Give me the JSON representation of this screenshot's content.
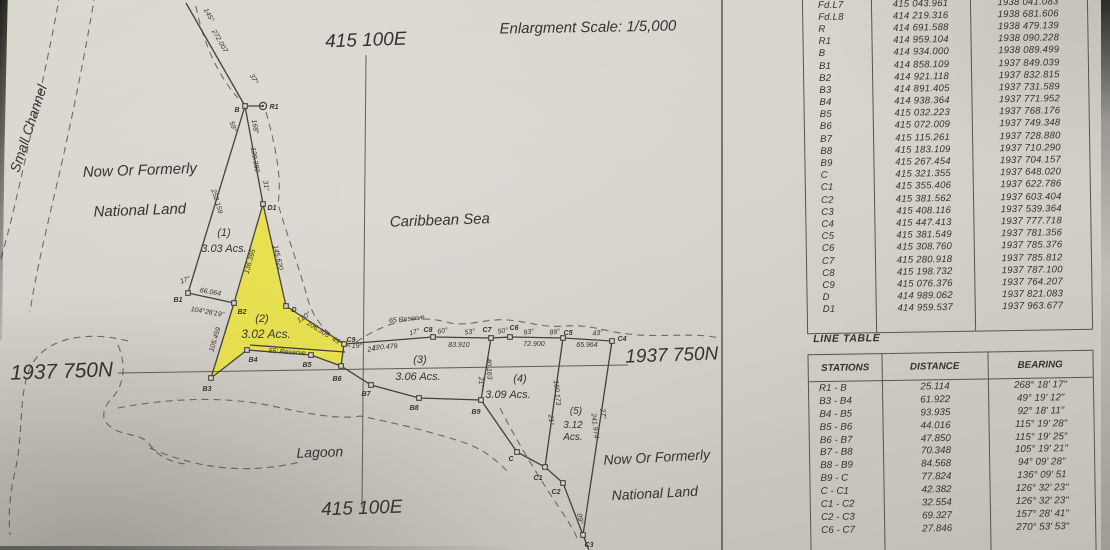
{
  "map": {
    "colors": {
      "line": "#45423c",
      "highlight": "#e9e23b",
      "marker_fill": "#d9d6ce"
    },
    "scale_note": "Enlargment Scale: 1/5,000",
    "parcels": [
      {
        "id": "(1)",
        "area": "3.03 Acs.",
        "highlighted": false
      },
      {
        "id": "(2)",
        "area": "3.02 Acs.",
        "highlighted": true
      },
      {
        "id": "(3)",
        "area": "3.06 Acs.",
        "highlighted": false
      },
      {
        "id": "(4)",
        "area": "3.09 Acs.",
        "highlighted": false
      },
      {
        "id": "(5)",
        "area": "3.12 Acs.",
        "highlighted": false
      }
    ],
    "grid": {
      "lines": [
        [
          366,
          55,
          362,
          508
        ],
        [
          118,
          373,
          628,
          365
        ]
      ]
    },
    "highlight_parcel": {
      "points": "263,206 234,303 211,378 247,350 311,355 341,366 344,344 286,306"
    },
    "solid_lines": [
      "186,3 245,106",
      "245,106 263,106",
      "245,106 188,293",
      "245,106 263,204",
      "188,293 234,303",
      "263,204 234,303",
      "234,303 211,378",
      "211,378 247,350",
      "247,350 311,355 341,366 371,385 419,398 481,400 517,452 545,467 563,483 583,535",
      "263,204 286,306",
      "286,306 344,344",
      "344,344 433,337 491,338 510,337 563,338 612,341",
      "491,338 481,400",
      "563,338 545,467",
      "612,341 583,535",
      "344,344 341,366",
      "250,345 345,352",
      "722,0 722,550",
      "583,535 589,550"
    ],
    "dashed_paths": [
      "M 60,-6 C 48,60 32,130 16,200 C 10,226 4,248 0,262",
      "M 95,-6 C 85,55 70,130 52,205 C 44,240 35,278 30,312",
      "M 128,341 C 86,330 44,338 30,368 C 18,395 24,436 14,476 C 10,496 8,516 10,535",
      "M 118,345 C 128,368 122,388 112,398 C 102,409 100,420 112,428 C 126,437 142,433 150,445 C 158,456 170,462 185,464",
      "M 150,448 C 200,470 250,474 300,462",
      "M 196,6 C 202,40 218,76 238,98",
      "M 266,112 C 276,148 282,178 278,204 C 288,238 300,270 308,300 C 316,326 334,340 354,348",
      "M 356,342 C 386,322 416,314 446,322 C 466,328 486,318 508,320 C 530,322 544,328 566,326 C 590,324 606,332 628,334 C 660,338 694,332 719,338",
      "M 118,408 C 170,398 225,396 272,406 C 305,413 338,420 360,416 C 400,424 440,434 468,444 C 488,452 498,462 508,472",
      "M 500,408 C 514,436 532,466 550,494 C 562,512 572,526 578,540"
    ],
    "stations": [
      {
        "id": "B",
        "x": 245,
        "y": 106,
        "shape": "square"
      },
      {
        "id": "R1",
        "x": 263,
        "y": 106,
        "shape": "circle"
      },
      {
        "id": "D1",
        "x": 263,
        "y": 204,
        "shape": "square"
      },
      {
        "id": "B1",
        "x": 188,
        "y": 293,
        "shape": "square"
      },
      {
        "id": "B2",
        "x": 234,
        "y": 303,
        "shape": "square"
      },
      {
        "id": "B3",
        "x": 211,
        "y": 378,
        "shape": "square"
      },
      {
        "id": "B4",
        "x": 247,
        "y": 350,
        "shape": "square"
      },
      {
        "id": "B5",
        "x": 311,
        "y": 355,
        "shape": "square"
      },
      {
        "id": "B6",
        "x": 341,
        "y": 366,
        "shape": "square"
      },
      {
        "id": "B7",
        "x": 371,
        "y": 385,
        "shape": "square"
      },
      {
        "id": "B8",
        "x": 419,
        "y": 398,
        "shape": "square"
      },
      {
        "id": "B9",
        "x": 481,
        "y": 400,
        "shape": "square"
      },
      {
        "id": "C",
        "x": 517,
        "y": 452,
        "shape": "square"
      },
      {
        "id": "C1",
        "x": 545,
        "y": 467,
        "shape": "square"
      },
      {
        "id": "C2",
        "x": 563,
        "y": 483,
        "shape": "square"
      },
      {
        "id": "C3",
        "x": 583,
        "y": 535,
        "shape": "square"
      },
      {
        "id": "C4",
        "x": 612,
        "y": 341,
        "shape": "square"
      },
      {
        "id": "C5",
        "x": 563,
        "y": 338,
        "shape": "square"
      },
      {
        "id": "C6",
        "x": 510,
        "y": 337,
        "shape": "square"
      },
      {
        "id": "C7",
        "x": 491,
        "y": 338,
        "shape": "square"
      },
      {
        "id": "C8",
        "x": 433,
        "y": 337,
        "shape": "square"
      },
      {
        "id": "C9",
        "x": 344,
        "y": 344,
        "shape": "square"
      },
      {
        "id": "D",
        "x": 286,
        "y": 306,
        "shape": "square"
      }
    ],
    "labels": [
      {
        "t": "Enlargment Scale: 1/5,000",
        "x": 588,
        "y": 32,
        "s": 15,
        "r": -1,
        "n": "scale-note"
      },
      {
        "t": "415 100E",
        "x": 366,
        "y": 46,
        "s": 19,
        "r": -2,
        "n": "grid-label-easting-top"
      },
      {
        "t": "415 100E",
        "x": 362,
        "y": 514,
        "s": 19,
        "r": -2,
        "n": "grid-label-easting-bottom"
      },
      {
        "t": "1937 750N",
        "x": 62,
        "y": 378,
        "s": 21,
        "r": -2,
        "n": "grid-label-northing-left"
      },
      {
        "t": "1937 750N",
        "x": 672,
        "y": 361,
        "s": 19,
        "r": -2,
        "n": "grid-label-northing-right"
      },
      {
        "t": "Small Channel",
        "x": 33,
        "y": 130,
        "s": 14,
        "r": -72,
        "n": "area-label-small-channel"
      },
      {
        "t": "Now Or Formerly",
        "x": 140,
        "y": 175,
        "s": 15,
        "r": -2,
        "n": "area-label-now-or-formerly-nw"
      },
      {
        "t": "National Land",
        "x": 140,
        "y": 215,
        "s": 15,
        "r": -2,
        "n": "area-label-national-land-nw"
      },
      {
        "t": "Caribbean Sea",
        "x": 440,
        "y": 225,
        "s": 15,
        "r": -2,
        "n": "area-label-caribbean-sea"
      },
      {
        "t": "Lagoon",
        "x": 320,
        "y": 457,
        "s": 14,
        "r": -2,
        "n": "area-label-lagoon"
      },
      {
        "t": "Now Or Formerly",
        "x": 657,
        "y": 462,
        "s": 14,
        "r": -3,
        "n": "area-label-now-or-formerly-se"
      },
      {
        "t": "National Land",
        "x": 655,
        "y": 498,
        "s": 14,
        "r": -3,
        "n": "area-label-national-land-se"
      },
      {
        "t": "(1)",
        "x": 224,
        "y": 236,
        "s": 11,
        "n": "parcel-1-id"
      },
      {
        "t": "3.03 Acs.",
        "x": 224,
        "y": 252,
        "s": 11,
        "n": "parcel-1-area"
      },
      {
        "t": "(2)",
        "x": 262,
        "y": 322,
        "s": 11,
        "n": "parcel-2-id"
      },
      {
        "t": "3.02 Acs.",
        "x": 266,
        "y": 338,
        "s": 12,
        "n": "parcel-2-area"
      },
      {
        "t": "(3)",
        "x": 420,
        "y": 363,
        "s": 11,
        "n": "parcel-3-id"
      },
      {
        "t": "3.06 Acs.",
        "x": 418,
        "y": 380,
        "s": 11,
        "n": "parcel-3-area"
      },
      {
        "t": "(4)",
        "x": 520,
        "y": 382,
        "s": 11,
        "n": "parcel-4-id"
      },
      {
        "t": "3.09 Acs.",
        "x": 508,
        "y": 398,
        "s": 11,
        "n": "parcel-4-area"
      },
      {
        "t": "(5)",
        "x": 576,
        "y": 414,
        "s": 10,
        "n": "parcel-5-id"
      },
      {
        "t": "3.12",
        "x": 573,
        "y": 428,
        "s": 10,
        "n": "parcel-5-area"
      },
      {
        "t": "Acs.",
        "x": 573,
        "y": 440,
        "s": 10,
        "n": "parcel-5-area-unit"
      },
      {
        "t": "B",
        "x": 237,
        "y": 112,
        "s": 7,
        "b": 1,
        "n": "station-label"
      },
      {
        "t": "R1",
        "x": 274,
        "y": 109,
        "s": 7,
        "b": 1,
        "n": "station-label"
      },
      {
        "t": "D1",
        "x": 272,
        "y": 210,
        "s": 7,
        "b": 1,
        "n": "station-label"
      },
      {
        "t": "B1",
        "x": 178,
        "y": 302,
        "s": 7,
        "b": 1,
        "n": "station-label"
      },
      {
        "t": "B2",
        "x": 242,
        "y": 314,
        "s": 7,
        "b": 1,
        "n": "station-label"
      },
      {
        "t": "B3",
        "x": 207,
        "y": 391,
        "s": 7,
        "b": 1,
        "n": "station-label"
      },
      {
        "t": "B4",
        "x": 253,
        "y": 362,
        "s": 7,
        "b": 1,
        "n": "station-label"
      },
      {
        "t": "B5",
        "x": 307,
        "y": 367,
        "s": 7,
        "b": 1,
        "n": "station-label"
      },
      {
        "t": "B6",
        "x": 337,
        "y": 381,
        "s": 7,
        "b": 1,
        "n": "station-label"
      },
      {
        "t": "B7",
        "x": 366,
        "y": 396,
        "s": 7,
        "b": 1,
        "n": "station-label"
      },
      {
        "t": "B8",
        "x": 414,
        "y": 410,
        "s": 7,
        "b": 1,
        "n": "station-label"
      },
      {
        "t": "B9",
        "x": 476,
        "y": 414,
        "s": 7,
        "b": 1,
        "n": "station-label"
      },
      {
        "t": "C",
        "x": 511,
        "y": 461,
        "s": 7,
        "b": 1,
        "n": "station-label"
      },
      {
        "t": "C1",
        "x": 538,
        "y": 480,
        "s": 7,
        "b": 1,
        "n": "station-label"
      },
      {
        "t": "C2",
        "x": 556,
        "y": 494,
        "s": 7,
        "b": 1,
        "n": "station-label"
      },
      {
        "t": "C3",
        "x": 589,
        "y": 547,
        "s": 7,
        "b": 1,
        "n": "station-label"
      },
      {
        "t": "C4",
        "x": 622,
        "y": 341,
        "s": 7,
        "b": 1,
        "n": "station-label"
      },
      {
        "t": "C5",
        "x": 568,
        "y": 335,
        "s": 7,
        "b": 1,
        "n": "station-label"
      },
      {
        "t": "C6",
        "x": 514,
        "y": 330,
        "s": 7,
        "b": 1,
        "n": "station-label"
      },
      {
        "t": "C7",
        "x": 487,
        "y": 332,
        "s": 7,
        "b": 1,
        "n": "station-label"
      },
      {
        "t": "C8",
        "x": 428,
        "y": 332,
        "s": 7,
        "b": 1,
        "n": "station-label"
      },
      {
        "t": "C9",
        "x": 351,
        "y": 342,
        "s": 7,
        "b": 1,
        "n": "station-label"
      },
      {
        "t": "D",
        "x": 294,
        "y": 312,
        "s": 7,
        "b": 1,
        "n": "station-label"
      },
      {
        "t": "145°",
        "x": 207,
        "y": 16,
        "s": 7,
        "r": 60,
        "n": "measure-label"
      },
      {
        "t": "272.007",
        "x": 218,
        "y": 42,
        "s": 7,
        "r": 60,
        "n": "measure-label"
      },
      {
        "t": "37°",
        "x": 252,
        "y": 80,
        "s": 7,
        "r": 60,
        "n": "measure-label"
      },
      {
        "t": "59°",
        "x": 231,
        "y": 127,
        "s": 7,
        "r": 72,
        "n": "measure-label"
      },
      {
        "t": "168°",
        "x": 253,
        "y": 127,
        "s": 7,
        "r": 80,
        "n": "measure-label"
      },
      {
        "t": "129.380",
        "x": 253,
        "y": 160,
        "s": 7,
        "r": 80,
        "n": "measure-label"
      },
      {
        "t": "31°",
        "x": 264,
        "y": 186,
        "s": 7,
        "r": 80,
        "n": "measure-label"
      },
      {
        "t": "252.159",
        "x": 215,
        "y": 202,
        "s": 7,
        "r": 73,
        "n": "measure-label"
      },
      {
        "t": "136.395",
        "x": 252,
        "y": 262,
        "s": 7,
        "r": -74,
        "n": "measure-label"
      },
      {
        "t": "145.620",
        "x": 276,
        "y": 258,
        "s": 7,
        "r": 77,
        "n": "measure-label"
      },
      {
        "t": "17°",
        "x": 186,
        "y": 282,
        "s": 7,
        "r": -20,
        "n": "measure-label"
      },
      {
        "t": "66.064",
        "x": 210,
        "y": 294,
        "s": 7,
        "r": 10,
        "n": "measure-label"
      },
      {
        "t": "104°26'19\"",
        "x": 207,
        "y": 314,
        "s": 7,
        "r": 10,
        "n": "measure-label"
      },
      {
        "t": "105.459",
        "x": 217,
        "y": 340,
        "s": 7,
        "r": -73,
        "n": "measure-label"
      },
      {
        "t": "120°",
        "x": 305,
        "y": 319,
        "s": 7,
        "r": -33,
        "n": "measure-label"
      },
      {
        "t": "106.305",
        "x": 317,
        "y": 331,
        "s": 7,
        "r": 33,
        "n": "measure-label"
      },
      {
        "t": "49°",
        "x": 336,
        "y": 343,
        "s": 7,
        "r": 33,
        "n": "measure-label"
      },
      {
        "t": "65' Reserve",
        "x": 287,
        "y": 354,
        "s": 7,
        "r": 4,
        "n": "measure-label"
      },
      {
        "t": "65 Reserve",
        "x": 407,
        "y": 321,
        "s": 7,
        "r": -6,
        "n": "measure-label"
      },
      {
        "t": "19°",
        "x": 357,
        "y": 348,
        "s": 7,
        "r": 0,
        "n": "measure-label"
      },
      {
        "t": "24°",
        "x": 373,
        "y": 351,
        "s": 7,
        "r": -8,
        "n": "measure-label"
      },
      {
        "t": "120.479",
        "x": 385,
        "y": 349,
        "s": 7,
        "r": -4,
        "n": "measure-label"
      },
      {
        "t": "17°",
        "x": 415,
        "y": 334,
        "s": 7,
        "r": -15,
        "n": "measure-label"
      },
      {
        "t": "60°",
        "x": 443,
        "y": 333,
        "s": 7,
        "r": -10,
        "n": "measure-label"
      },
      {
        "t": "83.910",
        "x": 459,
        "y": 347,
        "s": 7,
        "r": 0,
        "n": "measure-label"
      },
      {
        "t": "53°",
        "x": 470,
        "y": 334,
        "s": 7,
        "r": -8,
        "n": "measure-label"
      },
      {
        "t": "50°",
        "x": 503,
        "y": 333,
        "s": 7,
        "r": -8,
        "n": "measure-label"
      },
      {
        "t": "93°",
        "x": 529,
        "y": 334,
        "s": 7,
        "r": -8,
        "n": "measure-label"
      },
      {
        "t": "72.900",
        "x": 534,
        "y": 346,
        "s": 7,
        "r": 0,
        "n": "measure-label"
      },
      {
        "t": "89°",
        "x": 555,
        "y": 334,
        "s": 7,
        "r": -8,
        "n": "measure-label"
      },
      {
        "t": "65.964",
        "x": 587,
        "y": 347,
        "s": 7,
        "r": 0,
        "n": "measure-label"
      },
      {
        "t": "43°",
        "x": 598,
        "y": 335,
        "s": 7,
        "r": -8,
        "n": "measure-label"
      },
      {
        "t": "40.163",
        "x": 487,
        "y": 369,
        "s": 7,
        "r": 87,
        "n": "measure-label"
      },
      {
        "t": "21°",
        "x": 479,
        "y": 382,
        "s": 7,
        "r": 87,
        "n": "measure-label"
      },
      {
        "t": "160.173",
        "x": 555,
        "y": 393,
        "s": 7,
        "r": 84,
        "n": "measure-label"
      },
      {
        "t": "21°",
        "x": 549,
        "y": 420,
        "s": 7,
        "r": 84,
        "n": "measure-label"
      },
      {
        "t": "241.974",
        "x": 593,
        "y": 426,
        "s": 7,
        "r": 83,
        "n": "measure-label"
      },
      {
        "t": "27°",
        "x": 601,
        "y": 414,
        "s": 7,
        "r": 83,
        "n": "measure-label"
      },
      {
        "t": "09°",
        "x": 578,
        "y": 519,
        "s": 7,
        "r": 80,
        "n": "measure-label"
      }
    ]
  },
  "coordinate_table": {
    "rows": [
      [
        "Fd.L7",
        "415 043.961",
        "1938 041.083"
      ],
      [
        "Fd.L8",
        "414 219.316",
        "1938 681.606"
      ],
      [
        "R",
        "414 691.588",
        "1938 479.139"
      ],
      [
        "R1",
        "414 959.104",
        "1938 090.228"
      ],
      [
        "B",
        "414 934.000",
        "1938 089.499"
      ],
      [
        "B1",
        "414 858.109",
        "1937 849.039"
      ],
      [
        "B2",
        "414 921.118",
        "1937 832.815"
      ],
      [
        "B3",
        "414 891.405",
        "1937 731.589"
      ],
      [
        "B4",
        "414 938.364",
        "1937 771.952"
      ],
      [
        "B5",
        "415 032.223",
        "1937 768.176"
      ],
      [
        "B6",
        "415 072.009",
        "1937 749.348"
      ],
      [
        "B7",
        "415 115.261",
        "1937 728.880"
      ],
      [
        "B8",
        "415 183.109",
        "1937 710.290"
      ],
      [
        "B9",
        "415 267.454",
        "1937 704.157"
      ],
      [
        "C",
        "415 321.355",
        "1937 648.020"
      ],
      [
        "C1",
        "415 355.406",
        "1937 622.786"
      ],
      [
        "C2",
        "415 381.562",
        "1937 603.404"
      ],
      [
        "C3",
        "415 408.116",
        "1937 539.364"
      ],
      [
        "C4",
        "415 447.413",
        "1937 777.718"
      ],
      [
        "C5",
        "415 381.549",
        "1937 781.356"
      ],
      [
        "C6",
        "415 308.760",
        "1937 785.376"
      ],
      [
        "C7",
        "415 280.918",
        "1937 785.812"
      ],
      [
        "C8",
        "415 198.732",
        "1937 787.100"
      ],
      [
        "C9",
        "415 076.376",
        "1937 764.207"
      ],
      [
        "D",
        "414 989.062",
        "1937 821.083"
      ],
      [
        "D1",
        "414 959.537",
        "1937 963.677"
      ]
    ]
  },
  "line_table": {
    "title": "LINE TABLE",
    "headers": [
      "STATIONS",
      "DISTANCE",
      "BEARING"
    ],
    "rows": [
      [
        "R1 - B",
        "25.114",
        "268° 18' 17\""
      ],
      [
        "B3 - B4",
        "61.922",
        "49° 19' 12\""
      ],
      [
        "B4 - B5",
        "93.935",
        "92° 18' 11\""
      ],
      [
        "B5 - B6",
        "44.016",
        "115° 19' 28\""
      ],
      [
        "B6 - B7",
        "47.850",
        "115° 19' 25\""
      ],
      [
        "B7 - B8",
        "70.348",
        "105° 19' 21\""
      ],
      [
        "B8 - B9",
        "84.568",
        "94° 09' 28\""
      ],
      [
        "B9 - C",
        "77.824",
        "136° 09' 51"
      ],
      [
        "C - C1",
        "42.382",
        "126° 32' 23\""
      ],
      [
        "C1 - C2",
        "32.554",
        "126° 32' 23\""
      ],
      [
        "C2 - C3",
        "69.327",
        "157° 28' 41\""
      ],
      [
        "C6 - C7",
        "27.846",
        "270° 53' 53\""
      ]
    ]
  }
}
